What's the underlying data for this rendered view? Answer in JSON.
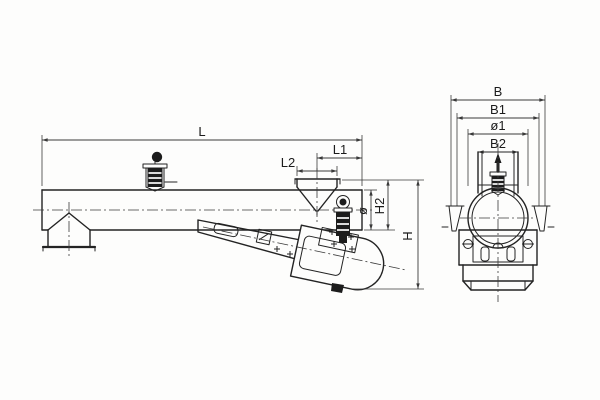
{
  "drawing": {
    "type": "technical-drawing",
    "subject": "vibrating tube feeder, side view and end view",
    "colors": {
      "background": "#fdfdfc",
      "line": "#232323",
      "dimension": "#3a3a3a"
    },
    "dimensions": {
      "L": "L",
      "L1": "L1",
      "L2": "L2",
      "dia": "ø",
      "H2": "H2",
      "H": "H",
      "B": "B",
      "B1": "B1",
      "dia1": "ø1",
      "B2": "B2"
    }
  }
}
